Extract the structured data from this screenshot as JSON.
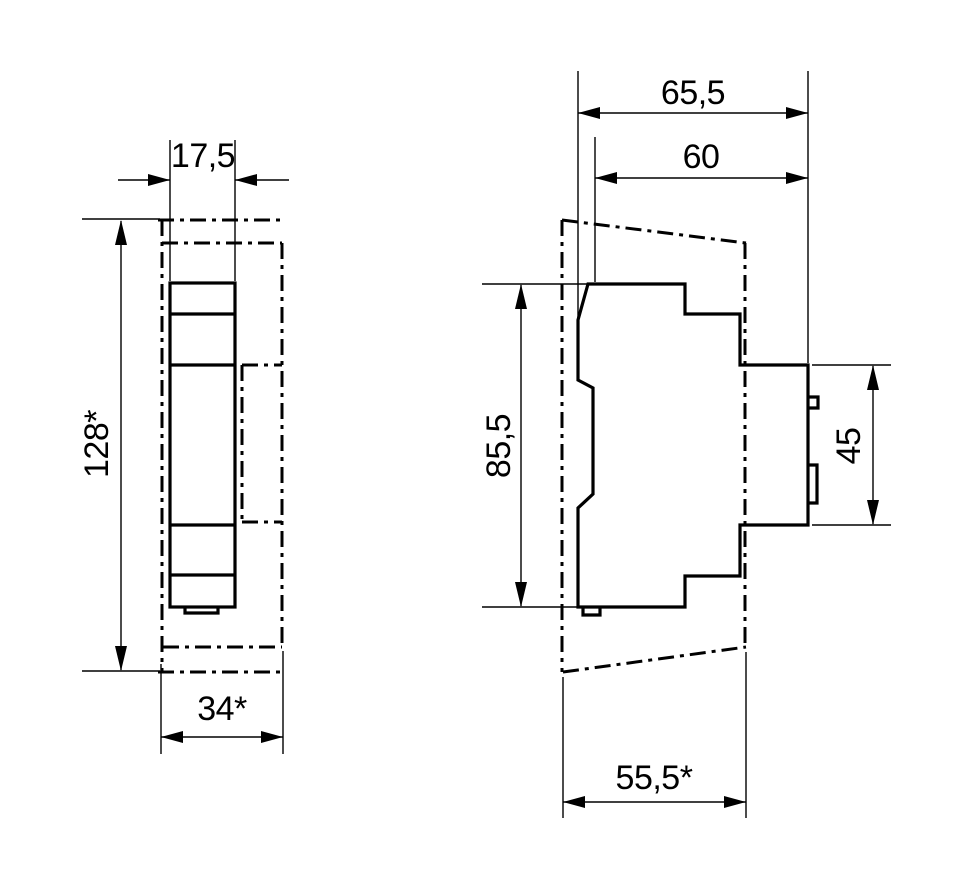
{
  "drawing": {
    "type": "technical-dimension-drawing",
    "background_color": "#ffffff",
    "line_color": "#000000",
    "views": {
      "front": {
        "title": "front-view",
        "dims": {
          "module_width": "17,5",
          "overall_height": "128*",
          "overall_width": "34*"
        }
      },
      "side": {
        "title": "side-view",
        "dims": {
          "overall_depth": "65,5",
          "body_depth": "60",
          "body_height": "85,5",
          "din_window_height": "45",
          "panel_recess_depth": "55,5*"
        }
      }
    }
  }
}
